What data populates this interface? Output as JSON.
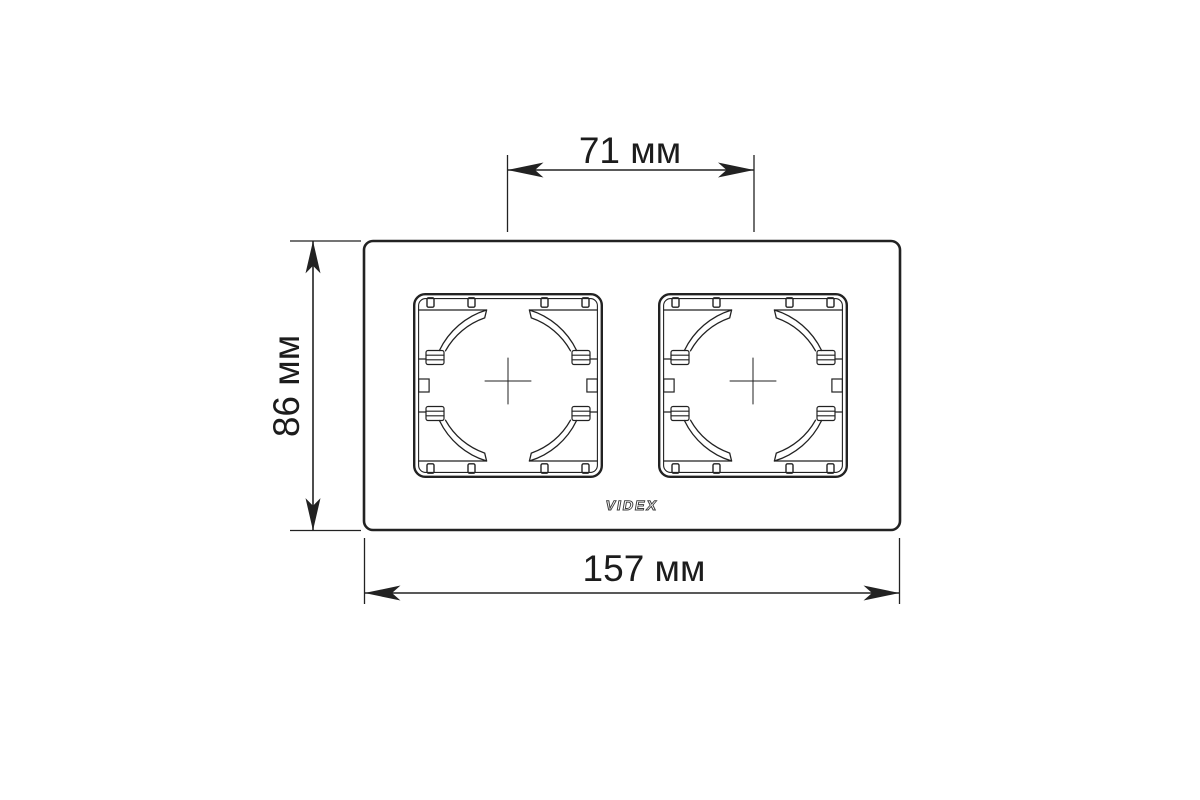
{
  "diagram": {
    "type": "technical-dimension-drawing",
    "subject": "double-socket-frame-front-view",
    "brand": {
      "logo_text": "VIDEX"
    },
    "dimensions": {
      "top": {
        "label": "71 мм",
        "meaning": "distance between module centers"
      },
      "left": {
        "label": "86 мм",
        "meaning": "frame height"
      },
      "bottom": {
        "label": "157 мм",
        "meaning": "frame width"
      }
    },
    "colors": {
      "line": "#222222",
      "text": "#1c1c1c",
      "background": "#ffffff"
    }
  }
}
